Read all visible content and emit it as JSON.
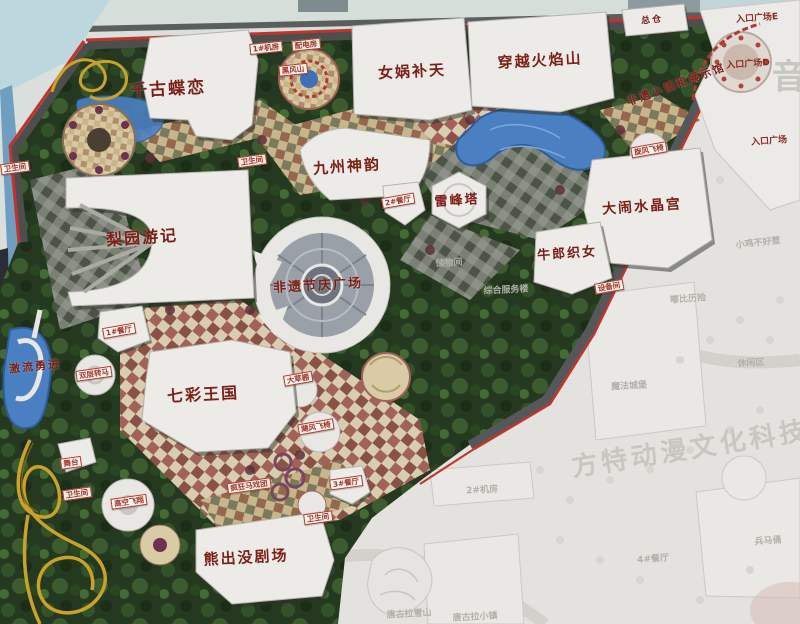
{
  "map": {
    "major_labels": [
      {
        "name": "attraction-qiangu-dielian",
        "text": "千古蝶恋",
        "x": 168,
        "y": 87,
        "size": 17,
        "rot": -3
      },
      {
        "name": "attraction-nuwa-butian",
        "text": "女娲补天",
        "x": 412,
        "y": 71,
        "size": 15,
        "rot": -3
      },
      {
        "name": "attraction-chuanyue-huoyanshan",
        "text": "穿越火焰山",
        "x": 540,
        "y": 60,
        "size": 15,
        "rot": -3
      },
      {
        "name": "building-zongcang",
        "text": "总仓",
        "x": 652,
        "y": 19,
        "size": 9,
        "rot": -6
      },
      {
        "name": "attraction-jiuzhou-shenyun",
        "text": "九州神韵",
        "x": 347,
        "y": 166,
        "size": 15,
        "rot": -4
      },
      {
        "name": "attraction-liyuan-youji",
        "text": "梨园游记",
        "x": 142,
        "y": 236,
        "size": 16,
        "rot": -4
      },
      {
        "name": "attraction-leifengta",
        "text": "雷峰塔",
        "x": 457,
        "y": 199,
        "size": 13,
        "rot": -4
      },
      {
        "name": "attraction-danao-shuijinggong",
        "text": "大闹水晶宫",
        "x": 642,
        "y": 206,
        "size": 14,
        "rot": -4
      },
      {
        "name": "attraction-niulang-zhinv",
        "text": "牛郎织女",
        "x": 567,
        "y": 252,
        "size": 13,
        "rot": -4
      },
      {
        "name": "plaza-feiyi-jieqing",
        "text": "非遗节庆广场",
        "x": 318,
        "y": 284,
        "size": 13,
        "rot": -3
      },
      {
        "name": "attraction-qicai-wangguo",
        "text": "七彩王国",
        "x": 203,
        "y": 393,
        "size": 16,
        "rot": -3
      },
      {
        "name": "attraction-xiongchumo-juchang",
        "text": "熊出没剧场",
        "x": 246,
        "y": 557,
        "size": 15,
        "rot": -3
      },
      {
        "name": "attraction-jiliu-yongjin",
        "text": "激流勇进",
        "x": 35,
        "y": 366,
        "size": 11,
        "rot": -6
      },
      {
        "name": "zone-feiyi-xiaozhen",
        "text": "非遗小镇和展示馆",
        "x": 676,
        "y": 84,
        "size": 11,
        "rot": -20
      }
    ],
    "facility_tags": [
      {
        "name": "tag-restroom-west",
        "text": "卫生间",
        "x": 15,
        "y": 168,
        "rot": -8
      },
      {
        "name": "tag-restroom-center",
        "text": "卫生间",
        "x": 252,
        "y": 161,
        "rot": -8
      },
      {
        "name": "tag-restaurant-2",
        "text": "2#餐厅",
        "x": 398,
        "y": 201,
        "rot": -10
      },
      {
        "name": "tag-restaurant-1",
        "text": "1#餐厅",
        "x": 119,
        "y": 331,
        "rot": -10
      },
      {
        "name": "tag-shuangceng-zhuanma",
        "text": "双层转马",
        "x": 94,
        "y": 374,
        "rot": -8
      },
      {
        "name": "tag-wutai",
        "text": "舞台",
        "x": 71,
        "y": 463,
        "rot": -8
      },
      {
        "name": "tag-restroom-south",
        "text": "卫生间",
        "x": 77,
        "y": 494,
        "rot": -8
      },
      {
        "name": "tag-gaokong-feixiang",
        "text": "高空飞翔",
        "x": 129,
        "y": 502,
        "rot": -8
      },
      {
        "name": "tag-fengkuang-maxituan",
        "text": "疯狂马戏团",
        "x": 249,
        "y": 486,
        "rot": -8
      },
      {
        "name": "tag-restaurant-3",
        "text": "3#餐厅",
        "x": 346,
        "y": 483,
        "rot": -8
      },
      {
        "name": "tag-restroom-southeast",
        "text": "卫生间",
        "x": 318,
        "y": 518,
        "rot": -8
      },
      {
        "name": "tag-dacaopeng",
        "text": "大草棚",
        "x": 298,
        "y": 379,
        "rot": -10
      },
      {
        "name": "tag-jufeng-feiyi",
        "text": "飓风飞椅",
        "x": 316,
        "y": 427,
        "rot": -10
      },
      {
        "name": "tag-xuanfeng-feiyi",
        "text": "旋风飞椅",
        "x": 649,
        "y": 150,
        "rot": -10
      },
      {
        "name": "tag-shebeijian",
        "text": "设备间",
        "x": 609,
        "y": 287,
        "rot": -10
      },
      {
        "name": "tag-jifang-1",
        "text": "1#机房",
        "x": 266,
        "y": 48,
        "rot": -6
      },
      {
        "name": "tag-peidianfang",
        "text": "配电房",
        "x": 306,
        "y": 45,
        "rot": -6
      },
      {
        "name": "tag-heifengshan",
        "text": "黑风山",
        "x": 293,
        "y": 70,
        "rot": -6
      }
    ],
    "entrance_labels": [
      {
        "name": "entrance-plaza-e",
        "text": "入口广场E",
        "x": 757,
        "y": 17,
        "rot": -4
      },
      {
        "name": "entrance-plaza-d",
        "text": "入口广场D",
        "x": 748,
        "y": 63,
        "rot": -4
      },
      {
        "name": "entrance-plaza",
        "text": "入口广场",
        "x": 769,
        "y": 140,
        "rot": -4
      }
    ],
    "faded_area_labels": [
      {
        "name": "faint-chuwujian",
        "text": "储物间",
        "x": 449,
        "y": 262,
        "rot": -3
      },
      {
        "name": "faint-zonghe-fuwulou",
        "text": "综合服务楼",
        "x": 506,
        "y": 289,
        "rot": -3
      },
      {
        "name": "faint-jifang-2",
        "text": "2#机房",
        "x": 482,
        "y": 489,
        "rot": -3
      },
      {
        "name": "faint-tanggula-xueshan",
        "text": "唐古拉雪山",
        "x": 409,
        "y": 613,
        "rot": -3
      },
      {
        "name": "faint-tanggula-xiaozhen",
        "text": "唐古拉小镇",
        "x": 475,
        "y": 616,
        "rot": -3
      },
      {
        "name": "faint-mofa-chengbao",
        "text": "魔法城堡",
        "x": 629,
        "y": 385,
        "rot": -3
      },
      {
        "name": "faint-xiaoji-buhaore",
        "text": "小鸡不好惹",
        "x": 758,
        "y": 242,
        "rot": -6
      },
      {
        "name": "faint-dubi-lixian",
        "text": "嘟比历险",
        "x": 688,
        "y": 298,
        "rot": -4
      },
      {
        "name": "faint-xiuxianqu",
        "text": "休闲区",
        "x": 751,
        "y": 362,
        "rot": -3
      },
      {
        "name": "faint-bingmayong",
        "text": "兵马俑",
        "x": 768,
        "y": 540,
        "rot": -4
      },
      {
        "name": "faint-restaurant-4",
        "text": "4#餐厅",
        "x": 653,
        "y": 558,
        "rot": -4
      }
    ],
    "watermarks": [
      {
        "name": "watermark-fangte",
        "text": "方特动漫文化科技",
        "x": 690,
        "y": 447,
        "size": 26,
        "rot": -9,
        "ls": 4
      },
      {
        "name": "watermark-yin",
        "text": "音",
        "x": 789,
        "y": 74,
        "size": 34,
        "rot": 0,
        "ls": 0
      }
    ]
  },
  "colors": {
    "label_red": "#7c2018",
    "tag_red": "#b03a2e",
    "water": "#4a7fc1",
    "foliage": "#24391f",
    "building": "#edebe7",
    "faded": "#e3e2de",
    "road_red": "#c2342b",
    "coaster_yellow": "#c9a227"
  }
}
